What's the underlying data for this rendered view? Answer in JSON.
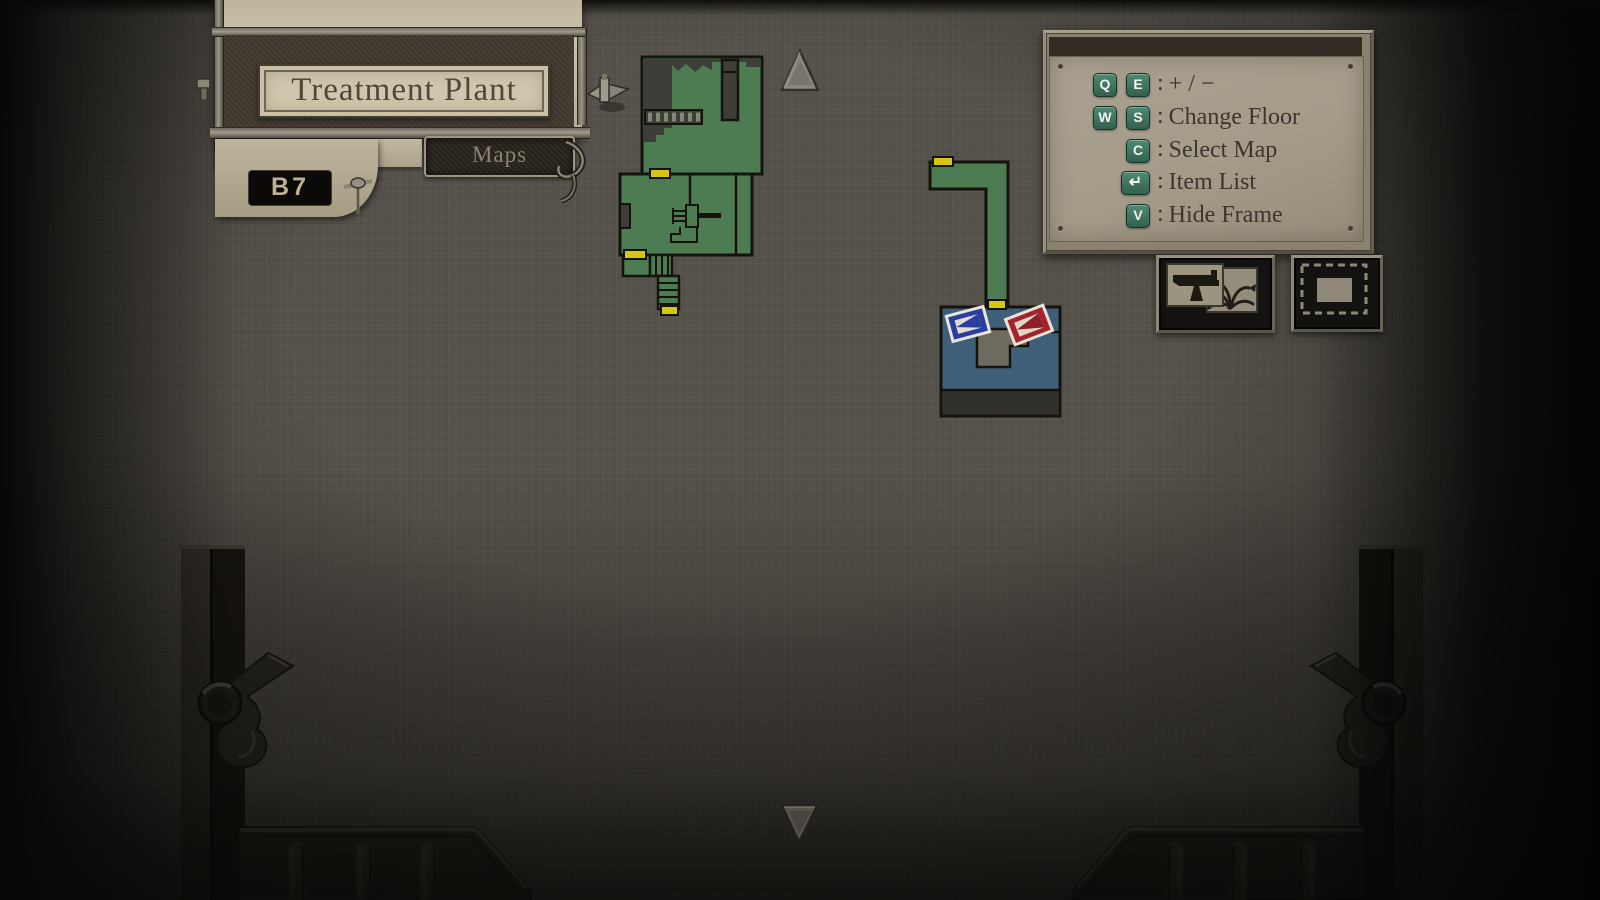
{
  "header": {
    "title": "Treatment Plant",
    "tab_label": "Maps",
    "floor_label": "B7"
  },
  "legend": {
    "separator": ":",
    "rows": [
      {
        "keys": [
          "Q",
          "E"
        ],
        "action": "+ / −"
      },
      {
        "keys": [
          "W",
          "S"
        ],
        "action": "Change Floor"
      },
      {
        "keys": [
          "C"
        ],
        "action": "Select Map"
      },
      {
        "keys": [
          "↵"
        ],
        "action": "Item List"
      },
      {
        "keys": [
          "V"
        ],
        "action": "Hide Frame"
      }
    ]
  },
  "toolbar": {
    "icons": [
      {
        "name": "equipment-items-toggle",
        "glyphs": [
          "handgun",
          "herb-plant"
        ]
      },
      {
        "name": "map-frame-toggle",
        "glyphs": [
          "dashed-frame",
          "solid-rectangle"
        ]
      }
    ]
  },
  "map": {
    "location": "Treatment Plant",
    "floor": "B7",
    "floor_up_available": true,
    "floor_down_available": true,
    "sectors": [
      {
        "name": "west-rooms",
        "state": "explored",
        "features": [
          "staircase",
          "unexplored-upper-area",
          "machinery",
          "stairwell-down"
        ],
        "door_markers": 3
      },
      {
        "name": "east-corridor",
        "state": "explored",
        "shape": "L-corridor",
        "door_markers": 2
      },
      {
        "name": "current-room",
        "state": "current",
        "features": [
          "unexplored-inner-area"
        ],
        "markers": [
          "player",
          "objective"
        ]
      }
    ],
    "markers": {
      "player": {
        "type": "blue-flag",
        "color": "#2c3da0"
      },
      "objective": {
        "type": "red-flag",
        "color": "#a3242e"
      }
    },
    "colors": {
      "explored": "#4d7c53",
      "unexplored": "#3e3d37",
      "current_room": "#3f5f78",
      "door": "#d7c513",
      "outline": "#15130e"
    }
  },
  "theme": {
    "background": "#56524b",
    "sign_beige": "#c3baa1",
    "sign_band": "#42392f",
    "legend_panel": "#a49b89",
    "key_cap": "#3f7a68",
    "text_dark": "#3e362c"
  }
}
